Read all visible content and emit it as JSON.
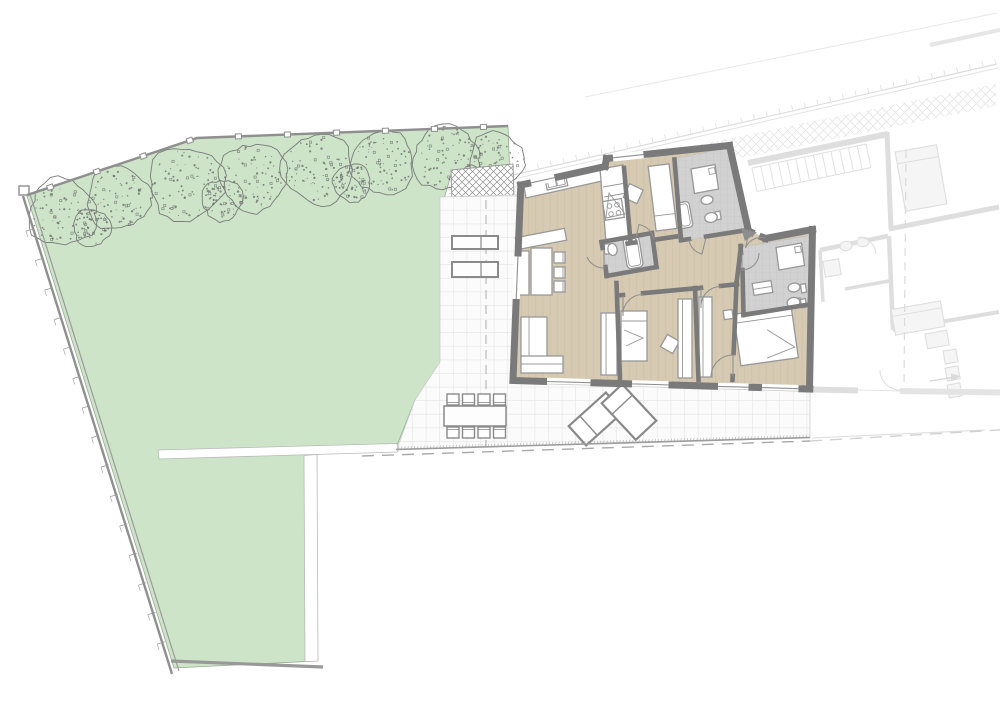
{
  "meta": {
    "kind": "architectural-site-and-floor-plan",
    "description": "Ground floor apartment plan with garden, tiled terrace and faded neighbouring unit",
    "visible_text": ""
  },
  "colors": {
    "bg": "#ffffff",
    "white": "#ffffff",
    "garden": "#cde4c9",
    "gardenEdge": "#96ab92",
    "treeLine": "#7a7a7a",
    "treeDot": "#6d6d6d",
    "fence": "#8f8f8f",
    "wall": "#7a7a7a",
    "wood": "#d7cab2",
    "plank": "#b9ab90",
    "bathFloor": "#d1d1d1",
    "bathGrid": "#c2c2c2",
    "tileBg": "#fbfbfb",
    "tileLine": "#e4e4e4",
    "furnStroke": "#989898",
    "furnFill": "#ffffff",
    "arc": "#909090",
    "boundary": "#9c9c9c",
    "dash": "#a9a9a9",
    "faded": "#d9d9d9",
    "fadedFill": "#f4f4f4",
    "lattice": "#8f8f8f",
    "latticeFaint": "#e1e1e1",
    "entry": "#8d8d8d"
  },
  "garden": {
    "trees": [
      [
        62,
        213,
        36
      ],
      [
        118,
        198,
        34
      ],
      [
        186,
        184,
        40
      ],
      [
        253,
        177,
        36
      ],
      [
        318,
        169,
        38
      ],
      [
        383,
        163,
        34
      ],
      [
        446,
        158,
        36
      ],
      [
        496,
        159,
        29
      ],
      [
        92,
        228,
        20
      ],
      [
        222,
        200,
        22
      ],
      [
        352,
        183,
        20
      ],
      [
        470,
        181,
        16
      ]
    ],
    "fence_posts": 10,
    "wall_ticks": 16
  },
  "terrace": {
    "dining_chairs_per_side": 4,
    "loungers": 2,
    "planters": 2
  },
  "apartment": {
    "rooms": [
      "living-kitchen",
      "hall-room",
      "bedroom-1",
      "bedroom-2",
      "master-bedroom",
      "bathroom",
      "small-bathroom",
      "ensuite",
      "corridor"
    ],
    "beds": 3,
    "door_arcs": 8
  },
  "neighbor": {
    "state": "faded",
    "features": [
      "staircase",
      "boundary-wall-with-ticks",
      "lattice-band",
      "adjacent-apartment"
    ]
  }
}
